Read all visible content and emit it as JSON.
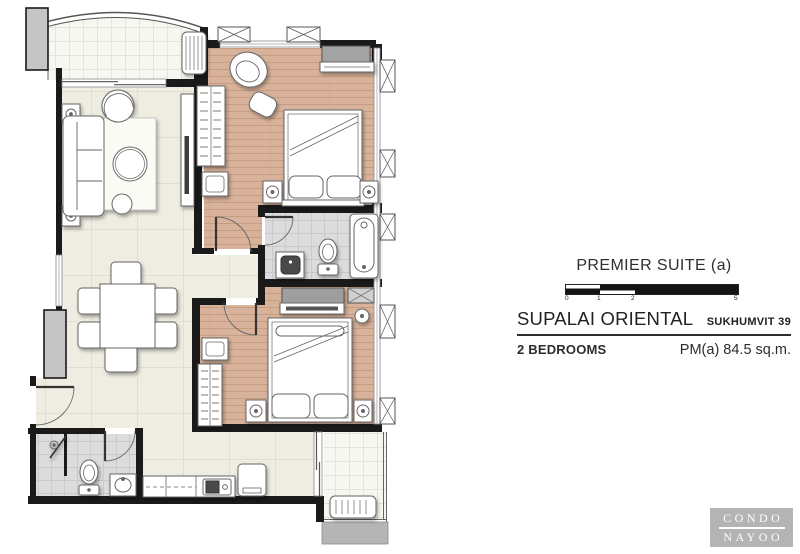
{
  "title_block": {
    "unit_type": "PREMIER SUITE (a)",
    "project": "SUPALAI ORIENTAL",
    "location": "SUKHUMVIT 39",
    "bedrooms": "2 BEDROOMS",
    "area": "PM(a) 84.5 sq.m.",
    "scale_ticks": [
      "0",
      "1",
      "2",
      "5"
    ]
  },
  "watermark": {
    "top": "CONDO",
    "bottom": "NAYOO"
  },
  "plan": {
    "rooms": [
      "living-dining",
      "master-bedroom",
      "bedroom-2",
      "master-bathroom",
      "bathroom-2",
      "kitchen",
      "front-balcony",
      "rear-balcony",
      "foyer"
    ],
    "colors": {
      "wall": "#1a1a1a",
      "wood_floor": "#d9b29b",
      "cream_floor": "#efede1",
      "tile_floor": "#dbdbdb",
      "furniture_gray": "#a3a3a3",
      "logo_bg": "#b4b4b4",
      "text": "#2d2d2d"
    }
  }
}
